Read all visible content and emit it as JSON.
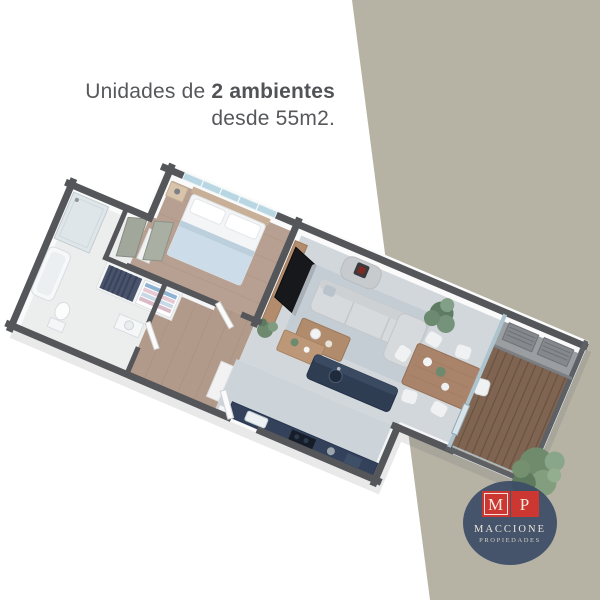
{
  "headline": {
    "line1_regular": "Unidades de ",
    "line1_bold": "2 ambientes",
    "line2": "desde 55m2."
  },
  "logo": {
    "initial_m": "M",
    "initial_p": "P",
    "name": "MACCIONE",
    "subtitle": "PROPIEDADES"
  },
  "colors": {
    "background": "#ffffff",
    "wedge": "#b6b3a4",
    "headline_text": "#57585b",
    "wall_dark": "#54565a",
    "bedroom_wood_floor": "#b7a091",
    "living_floor": "#d2d7dc",
    "kitchen_navy": "#2e3d52",
    "balcony_deck": "#7e6451",
    "plant_green": "#6f8b6c",
    "logo_circle": "#3c4c66",
    "logo_red": "#cd3731"
  }
}
